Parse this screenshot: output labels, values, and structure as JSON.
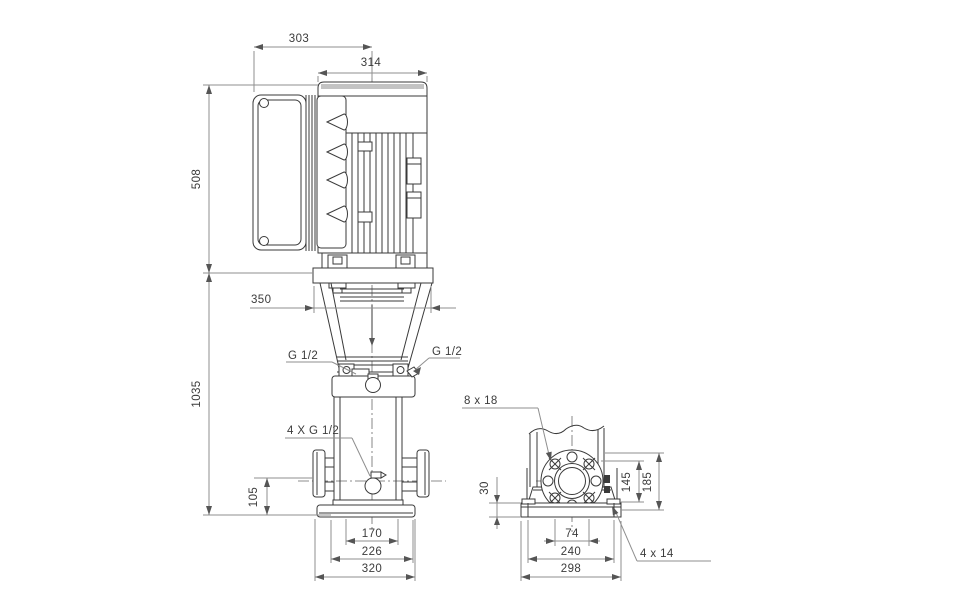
{
  "drawing": {
    "left_view": {
      "dim_303": "303",
      "dim_314": "314",
      "dim_508": "508",
      "dim_350": "350",
      "dim_1035": "1035",
      "dim_105": "105",
      "dim_170": "170",
      "dim_226": "226",
      "dim_320": "320",
      "label_g12_left": "G 1/2",
      "label_g12_right": "G 1/2",
      "label_4xg12": "4 X G 1/2"
    },
    "right_view": {
      "label_8x18": "8 x 18",
      "dim_30": "30",
      "dim_145": "145",
      "dim_185": "185",
      "dim_74": "74",
      "dim_240": "240",
      "dim_298": "298",
      "label_4x14": "4 x 14"
    }
  }
}
